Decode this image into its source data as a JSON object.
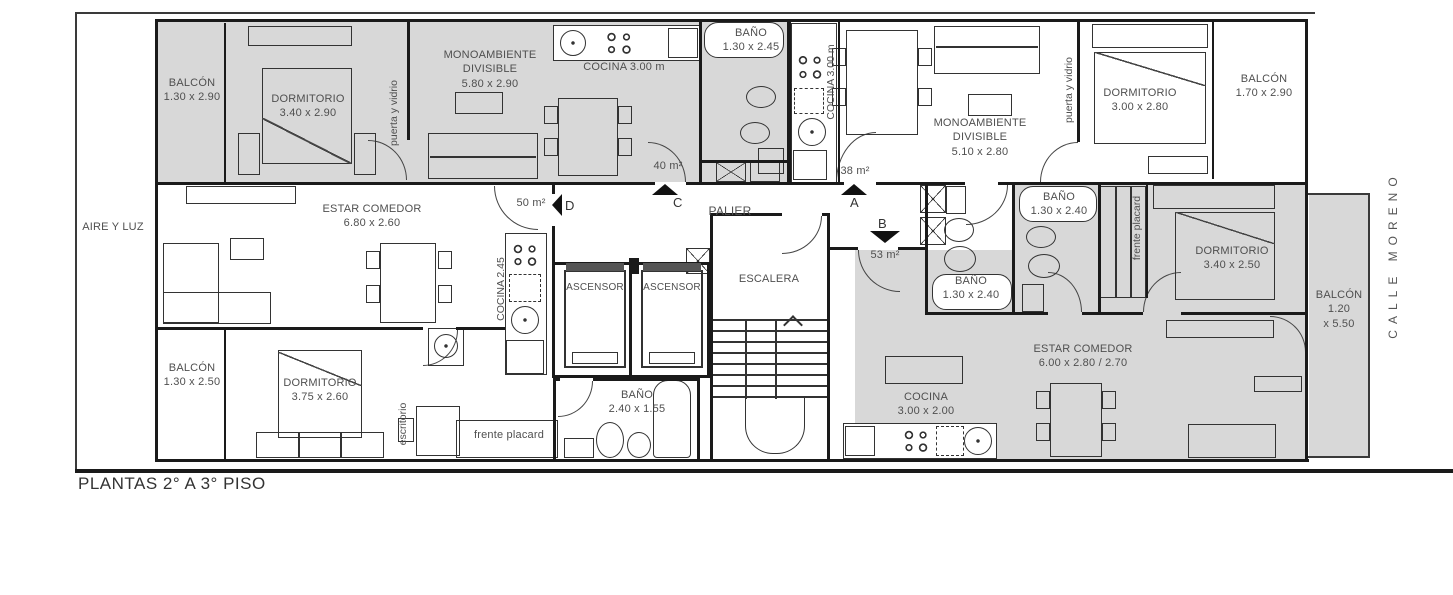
{
  "colors": {
    "room_fill": "#d8d8d8",
    "wall": "#1a1a1a",
    "text": "#4f4f4f"
  },
  "title": "PLANTAS 2° A 3° PISO",
  "site": {
    "aire_y_luz": "AIRE Y LUZ",
    "street": "CALLE MORENO"
  },
  "core": {
    "palier": "PALIER",
    "escalera": "ESCALERA",
    "ascensor_left": "ASCENSOR",
    "ascensor_right": "ASCENSOR"
  },
  "markers": {
    "a": {
      "letter": "A",
      "area": "38 m²"
    },
    "b": {
      "letter": "B",
      "area": "53 m²"
    },
    "c": {
      "letter": "C",
      "area": "40 m²"
    },
    "d": {
      "letter": "D",
      "area": "50 m²"
    }
  },
  "unit_c": {
    "balcon": {
      "name": "BALCÓN",
      "dim": "1.30 x 2.90"
    },
    "dormitorio": {
      "name": "DORMITORIO",
      "dim": "3.40 x 2.90"
    },
    "puerta_y_vidrio": "puerta y vidrio",
    "monoambiente": {
      "line1": "MONOAMBIENTE",
      "line2": "DIVISIBLE",
      "dim": "5.80 x 2.90"
    },
    "cocina": "COCINA 3.00 m",
    "bano": {
      "name": "BAÑO",
      "dim": "1.30 x 2.45"
    }
  },
  "unit_a": {
    "cocina": "COCINA 3.00 m",
    "monoambiente": {
      "line1": "MONOAMBIENTE",
      "line2": "DIVISIBLE",
      "dim": "5.10 x 2.80"
    },
    "puerta_y_vidrio": "puerta y vidrio",
    "dormitorio": {
      "name": "DORMITORIO",
      "dim": "3.00 x 2.80"
    },
    "balcon": {
      "name": "BALCÓN",
      "dim": "1.70 x 2.90"
    },
    "bano": {
      "name": "BAÑO",
      "dim": "1.30 x 2.40"
    }
  },
  "unit_d": {
    "estar_comedor": {
      "name": "ESTAR COMEDOR",
      "dim": "6.80 x 2.60"
    },
    "cocina": "COCINA 2.45",
    "dormitorio": {
      "name": "DORMITORIO",
      "dim": "3.75 x 2.60"
    },
    "balcon": {
      "name": "BALCÓN",
      "dim": "1.30 x 2.50"
    },
    "bano": {
      "name": "BAÑO",
      "dim": "2.40 x 1.55"
    },
    "escritorio": "escritorio",
    "frente_placard": "frente placard"
  },
  "unit_b": {
    "bano": {
      "name": "BAÑO",
      "dim": "1.30 x 2.40"
    },
    "frente_placard": "frente placard",
    "dormitorio": {
      "name": "DORMITORIO",
      "dim": "3.40 x 2.50"
    },
    "estar_comedor": {
      "name": "ESTAR COMEDOR",
      "dim": "6.00 x 2.80 / 2.70"
    },
    "cocina": {
      "name": "COCINA",
      "dim": "3.00 x 2.00"
    },
    "balcon": {
      "name": "BALCÓN",
      "dim_w": "1.20",
      "dim_h": "x 5.50"
    }
  }
}
